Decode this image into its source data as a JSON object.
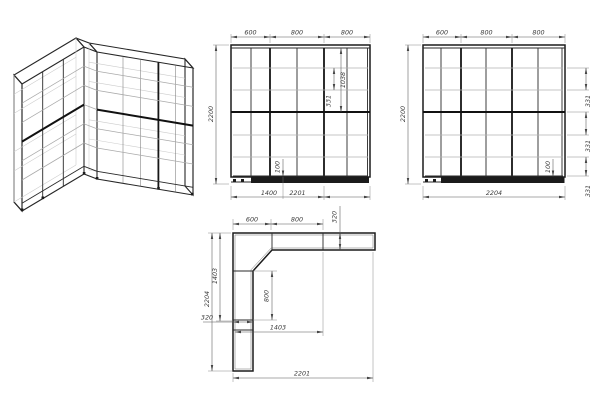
{
  "front_view": {
    "top_dims": [
      "600",
      "800",
      "800"
    ],
    "height_dim": "2200",
    "dim_1038": "1038",
    "dim_331": "331",
    "dim_100": "100",
    "bottom_dims": [
      "1400",
      "2201"
    ]
  },
  "side_view": {
    "top_dims": [
      "600",
      "800",
      "800"
    ],
    "height_dim": "2200",
    "shelf_dims": [
      "331",
      "331",
      "331"
    ],
    "plinth_dim": "100",
    "bottom_dim": "2204"
  },
  "plan_view": {
    "top_dims": [
      "600",
      "800"
    ],
    "depth_dim": "320",
    "left_dims": [
      "1403",
      "2204"
    ],
    "left_width_dim": "320",
    "inner_dims": [
      "800",
      "1403"
    ],
    "bottom_dim": "2201"
  },
  "colors": {
    "line": "#1c1c1c",
    "shelf": "#b2b2b2",
    "dim_line": "#555555",
    "text": "#3a3a3a",
    "background": "#ffffff"
  }
}
